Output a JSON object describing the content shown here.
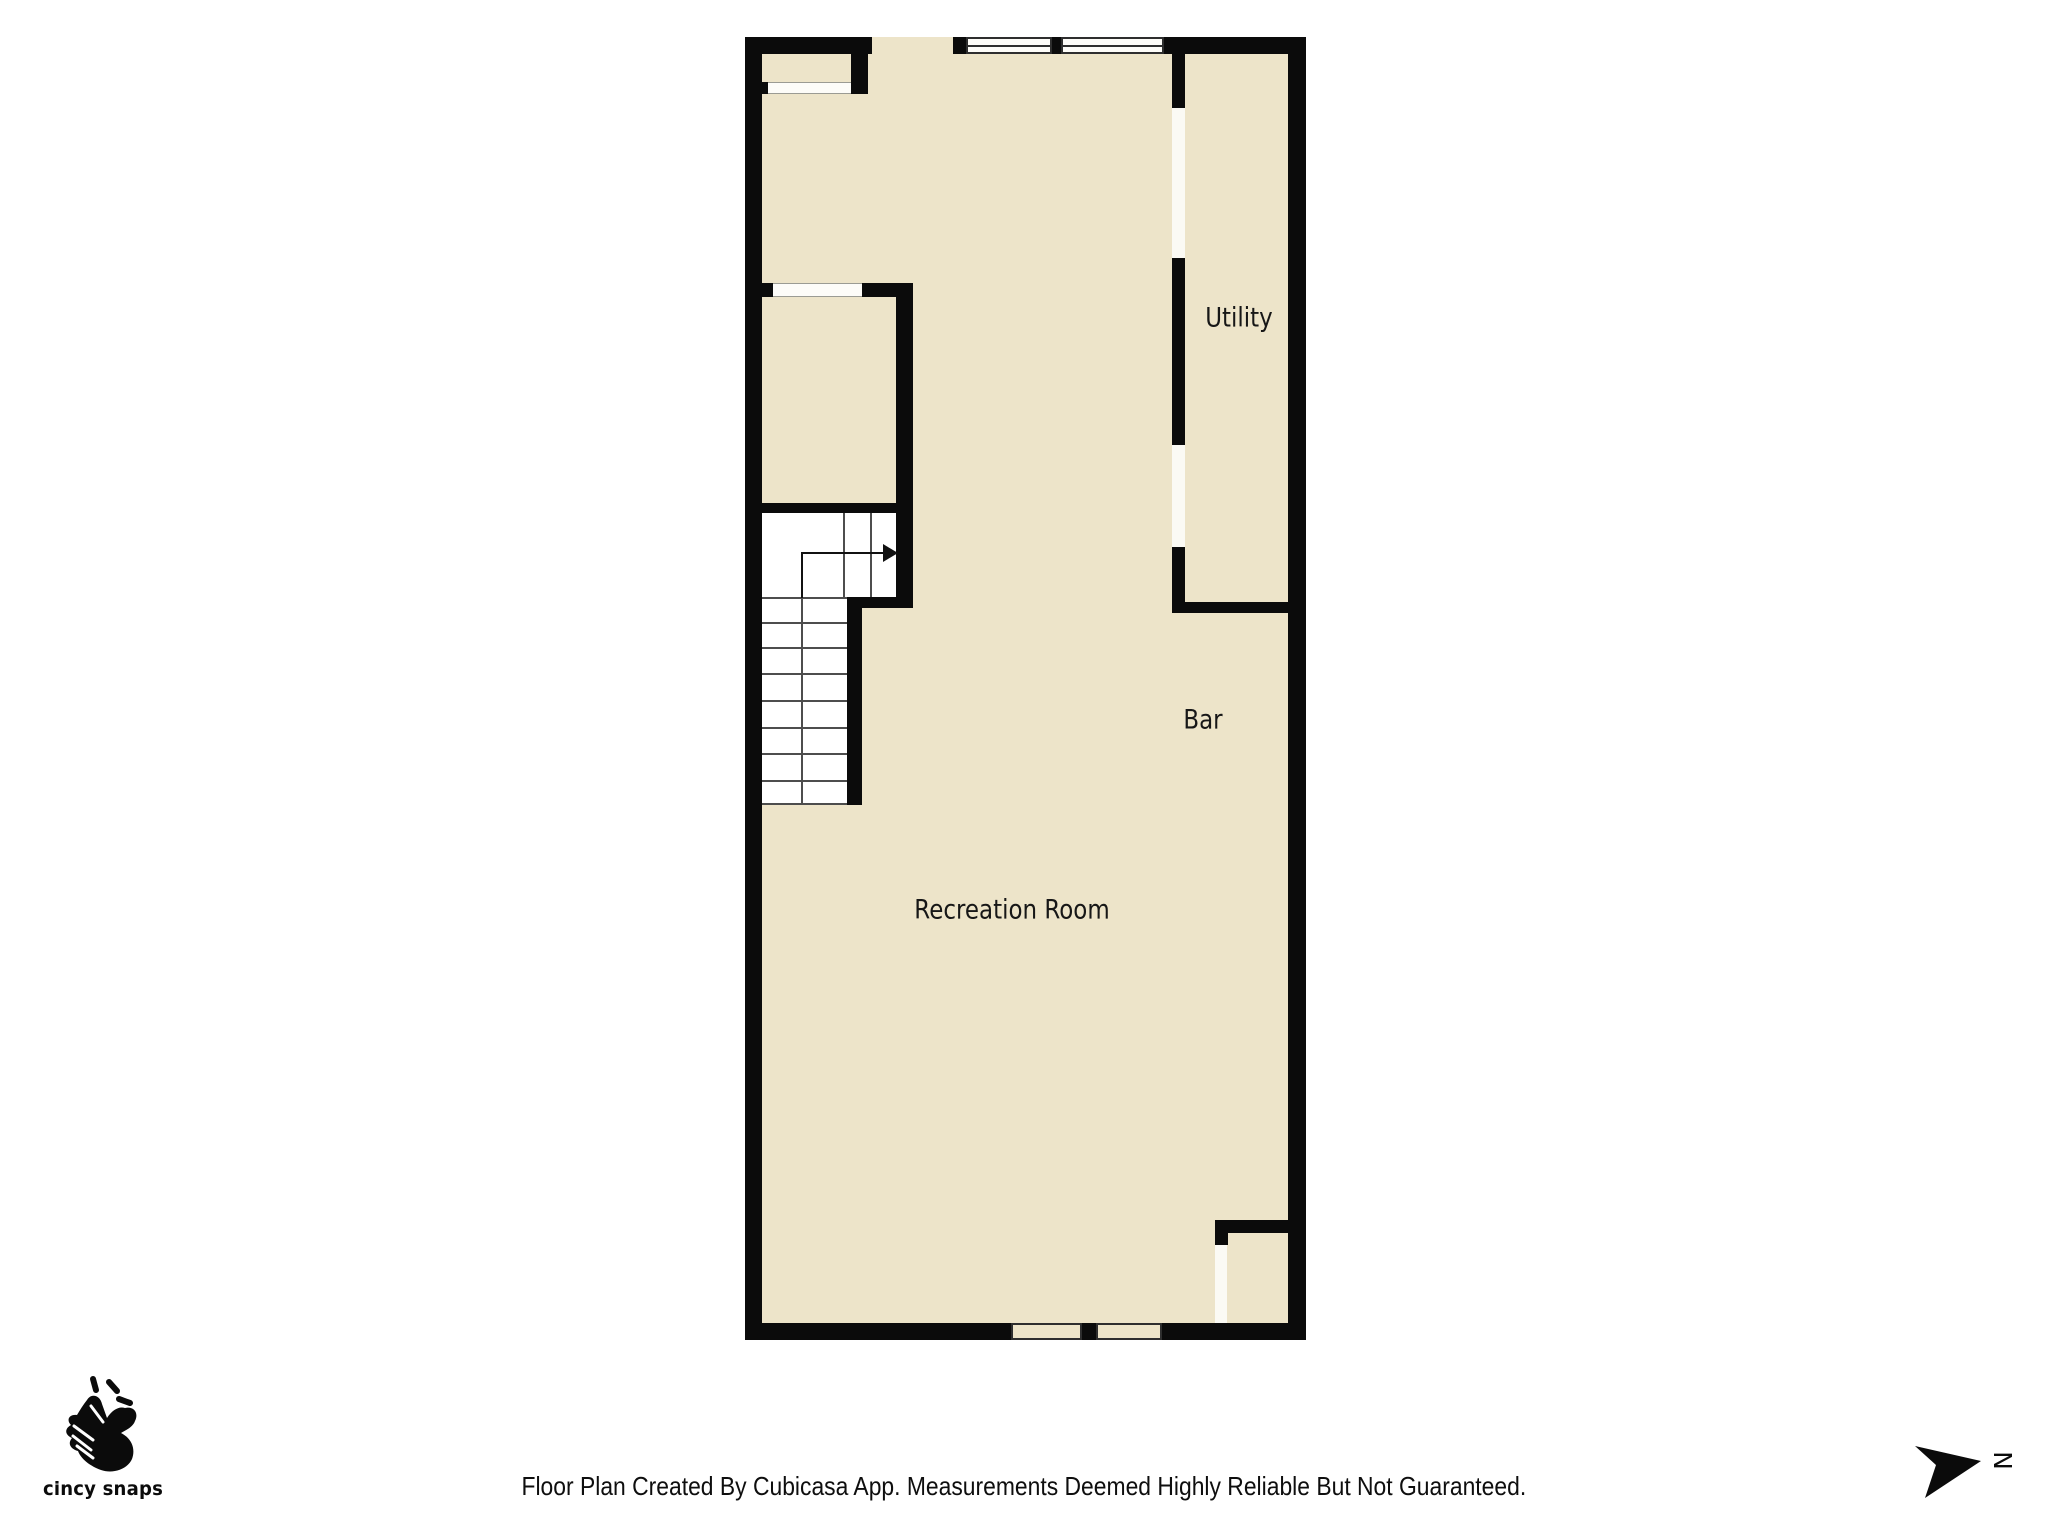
{
  "plan": {
    "floor_color": "#ede4c9",
    "wall_color": "#0b0b0b",
    "rooms": [
      {
        "label": "Utility"
      },
      {
        "label": "Bar"
      },
      {
        "label": "Recreation Room"
      }
    ],
    "stairs": {
      "direction_arrow": "right"
    }
  },
  "branding": {
    "logo_text": "cincy snaps"
  },
  "compass": {
    "north_label": "N"
  },
  "footer": {
    "disclaimer": "Floor Plan Created By Cubicasa App. Measurements Deemed Highly Reliable But Not Guaranteed."
  }
}
